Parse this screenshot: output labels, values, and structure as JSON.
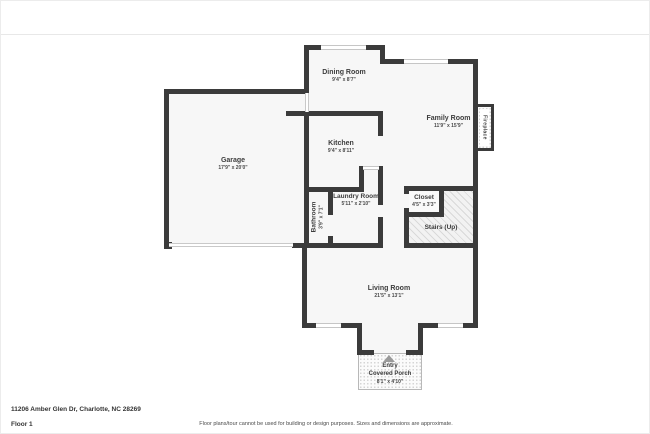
{
  "meta": {
    "address": "11206 Amber Glen Dr, Charlotte, NC 28269",
    "floor_label": "Floor 1",
    "disclaimer": "Floor plans/tour cannot be used for building or design purposes. Sizes and dimensions are approximate."
  },
  "rooms": {
    "dining": {
      "name": "Dining Room",
      "dims": "9'4\" x 8'7\""
    },
    "family": {
      "name": "Family Room",
      "dims": "11'9\" x 15'9\""
    },
    "kitchen": {
      "name": "Kitchen",
      "dims": "9'4\" x 8'11\""
    },
    "garage": {
      "name": "Garage",
      "dims": "17'9\" x 20'0\""
    },
    "laundry": {
      "name": "Laundry Room",
      "dims": "5'11\" x 2'10\""
    },
    "bathroom": {
      "name": "Bathroom",
      "dims": "3'9\" x 7'1\""
    },
    "closet": {
      "name": "Closet",
      "dims": "4'5\" x 3'3\""
    },
    "stairs": {
      "name": "Stairs (Up)"
    },
    "living": {
      "name": "Living Room",
      "dims": "21'5\" x 13'1\""
    },
    "porch": {
      "line1": "Entry",
      "line2": "Covered Porch",
      "dims": "8'1\" x 4'10\""
    },
    "fireplace": {
      "name": "Fireplace"
    }
  },
  "colors": {
    "wall": "#3b3b3b",
    "room_fill": "#f7f7f7",
    "text": "#3d3d3d",
    "window_line": "#c6c6c6"
  }
}
